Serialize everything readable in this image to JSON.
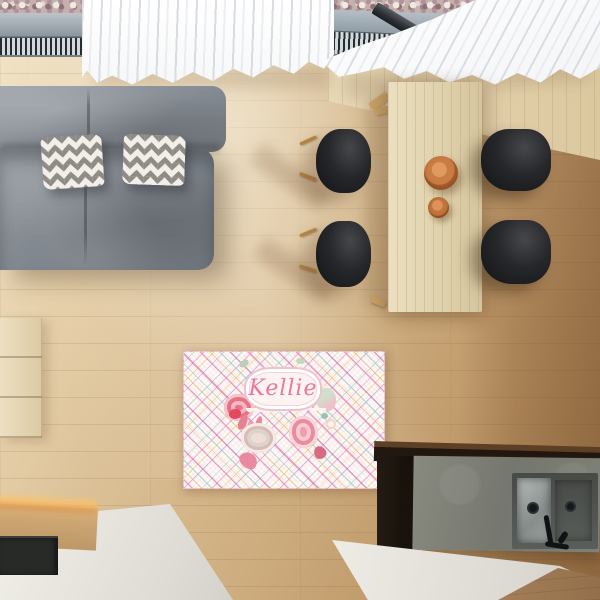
{
  "meta": {
    "description": "Overhead 3D render of a living/dining room used as a product mockup for a personalized area rug",
    "view": "top-down"
  },
  "rug": {
    "name_text": "Kellie",
    "text_color": "#e8799c",
    "pattern": "diagonal plaid with watercolor roses and ornate name label",
    "background": "#fdfaf8",
    "plaid_colors": [
      "#ec82a5",
      "#f0aa5a",
      "#96c8b9",
      "#cd5f9b",
      "#b996cd",
      "#f0c86e"
    ]
  },
  "palette": {
    "floor_light": "#f1e3c6",
    "floor_mid": "#cfaf81",
    "floor_dark_right": "#a87f52",
    "sofa_gray": "#82888f",
    "pillow_gray": "#8e8a84",
    "pillow_white": "#f2efe9",
    "curtain_white": "#fbfbfc",
    "table_wood": "#e0d2ac",
    "chair_black": "#1c1d1f",
    "bowl_terracotta": "#c97d43",
    "counter_white": "#eceae4",
    "concrete_gray": "#7e8177",
    "island_black": "#1a130d",
    "sink_steel": "#a8aeac",
    "underlight_amber": "#fdc268",
    "gravel_mauve": "#c5b0ac",
    "grille_dark": "#272c31"
  },
  "objects": [
    "gravel-bed",
    "window-sill",
    "heating-grille-left",
    "heating-grille-right",
    "window-post",
    "skylight-bar",
    "curtain-left",
    "curtain-right",
    "wood-wall",
    "sofa-back",
    "sofa-seat",
    "chevron-pillow-1",
    "chevron-pillow-2",
    "drawer-cabinet",
    "dining-table",
    "bench",
    "chair-top-left",
    "chair-bottom-left",
    "chair-top-right",
    "chair-bottom-right",
    "bowl-large",
    "bowl-small",
    "personalized-rug",
    "white-countertop",
    "under-cabinet-glow",
    "cooktop",
    "kitchen-island",
    "concrete-counter",
    "double-sink",
    "faucet",
    "wood-floor"
  ]
}
